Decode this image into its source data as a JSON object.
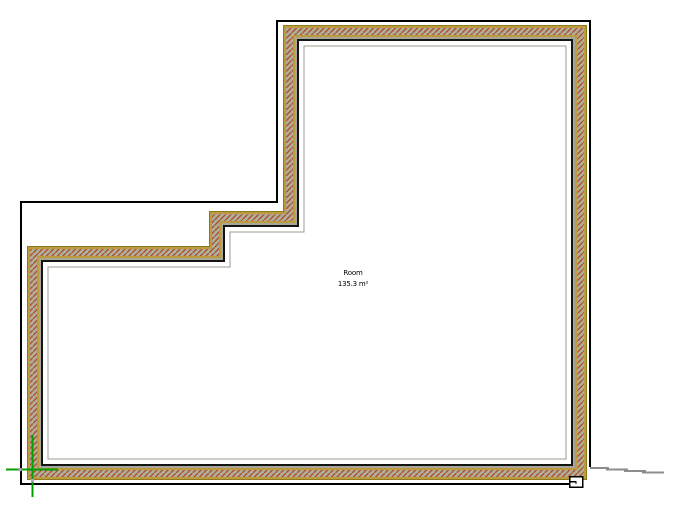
{
  "room_tag": {
    "name": "Room",
    "area": "135.3 m²"
  },
  "colors": {
    "canvas_background": "#ffffff",
    "wall_skin_tan": "#bd9a3d",
    "wall_exterior_edge_khaki": "#8c7a1e",
    "hatch_background_gray": "#adada0",
    "hatch_stroke_red": "#b24a16",
    "wall_inner_gray_line": "#a6a69b",
    "wall_interior_edge_black": "#141414",
    "room_boundary_faint_gray": "#9c9c92",
    "roof_outline_black": "#000000",
    "origin_green": "#00a000",
    "grip_pink": "#c79ac7",
    "terrain_gray": "#8c8c8c",
    "marker_fill": "#ffffff"
  },
  "floor_plan": {
    "wall_exterior_polygon": [
      [
        283,
        25
      ],
      [
        587,
        25
      ],
      [
        587,
        480
      ],
      [
        27,
        480
      ],
      [
        27,
        246
      ],
      [
        209,
        246
      ],
      [
        209,
        211
      ],
      [
        283,
        211
      ]
    ],
    "wall_offset_signs": [
      [
        1,
        1
      ],
      [
        -1,
        1
      ],
      [
        -1,
        -1
      ],
      [
        1,
        -1
      ],
      [
        1,
        1
      ],
      [
        1,
        1
      ],
      [
        1,
        1
      ],
      [
        1,
        1
      ]
    ],
    "wall_thickness_px": 16,
    "roof_outline_points": [
      [
        590,
        467
      ],
      [
        590,
        21
      ],
      [
        277,
        21
      ],
      [
        277,
        202
      ],
      [
        21,
        202
      ],
      [
        21,
        484
      ],
      [
        569,
        484
      ]
    ],
    "terrain_segments": [
      [
        [
          590,
          468
        ],
        [
          609,
          468
        ]
      ],
      [
        [
          606,
          469.5
        ],
        [
          628,
          469.5
        ]
      ],
      [
        [
          624,
          471
        ],
        [
          646,
          471
        ]
      ],
      [
        [
          642,
          472.5
        ],
        [
          664,
          472.5
        ]
      ]
    ],
    "origin_marker": {
      "vertical": {
        "x": 32.5,
        "y1": 435,
        "y2": 497
      },
      "horizontal": {
        "y": 469.5,
        "x1": 6,
        "x2": 58
      }
    },
    "grips": [
      [
        20,
        469.5
      ],
      [
        32.5,
        480.5
      ]
    ],
    "end_marker": {
      "x": 569.5,
      "y": 476.5,
      "w": 13,
      "h": 10.5
    }
  }
}
